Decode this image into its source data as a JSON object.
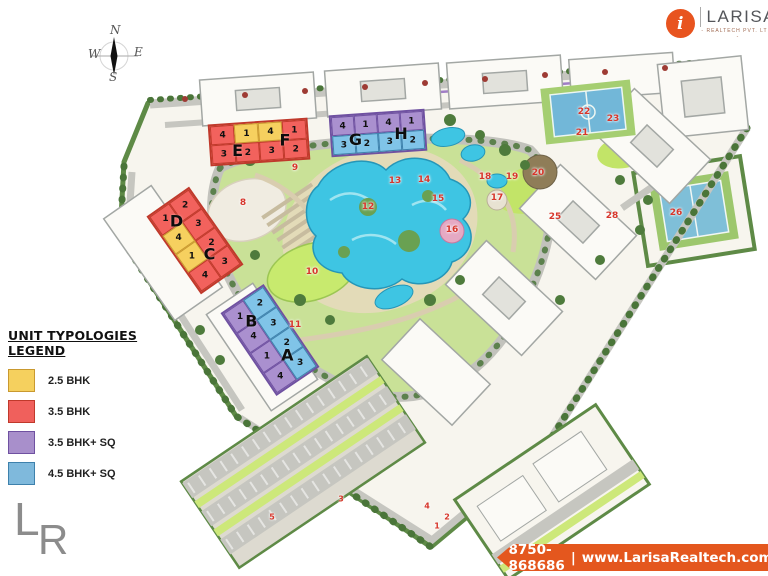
{
  "brand": {
    "name": "LARISA",
    "tagline": "- REALTECH PVT. LTD. -",
    "logo_letter": "i",
    "accent": "#E8541F"
  },
  "compass": {
    "north": "N",
    "south": "S",
    "east": "E",
    "west": "W"
  },
  "legend": {
    "title": "UNIT TYPOLOGIES LEGEND",
    "items": [
      {
        "label": "2.5 BHK",
        "color": "#F5D05E",
        "border": "#C9992F"
      },
      {
        "label": "3.5 BHK",
        "color": "#F0605C",
        "border": "#C0392B"
      },
      {
        "label": "3.5 BHK+ SQ",
        "color": "#A88FCB",
        "border": "#6F51A1"
      },
      {
        "label": "4.5 BHK+ SQ",
        "color": "#7FB9DC",
        "border": "#3E81AC"
      }
    ]
  },
  "footer": {
    "phone": "8750-868686",
    "separator": "|",
    "website": "www.LarisaRealtech.com",
    "bg": "#E4571E"
  },
  "watermark": {
    "letter_l": "L",
    "letter_r": "R"
  },
  "unit_colors": {
    "yellow": {
      "fill": "#F6D05F",
      "border": "#C9992F"
    },
    "red": {
      "fill": "#F2625D",
      "border": "#C0392B"
    },
    "purple": {
      "fill": "#AA90CF",
      "border": "#6F51A1"
    },
    "blue": {
      "fill": "#80C4E8",
      "border": "#3E81AC"
    }
  },
  "blocks": [
    {
      "name": "EF",
      "x": 209,
      "y": 121,
      "w": 100,
      "h": 42,
      "rot": -4,
      "rows": 2,
      "cols": 4,
      "border": "red",
      "cells": [
        {
          "n": "4",
          "c": "red"
        },
        {
          "n": "1",
          "c": "yellow"
        },
        {
          "n": "4",
          "c": "yellow"
        },
        {
          "n": "1",
          "c": "red"
        },
        {
          "n": "3",
          "c": "red"
        },
        {
          "n": "2",
          "c": "red"
        },
        {
          "n": "3",
          "c": "red"
        },
        {
          "n": "2",
          "c": "red"
        }
      ],
      "letters": [
        {
          "t": "E",
          "x": 27,
          "y": 68
        },
        {
          "t": "F",
          "x": 77,
          "y": 50
        }
      ]
    },
    {
      "name": "GH",
      "x": 330,
      "y": 112,
      "w": 96,
      "h": 42,
      "rot": -4,
      "rows": 2,
      "cols": 4,
      "border": "purple",
      "cells": [
        {
          "n": "4",
          "c": "purple"
        },
        {
          "n": "1",
          "c": "purple"
        },
        {
          "n": "4",
          "c": "purple"
        },
        {
          "n": "1",
          "c": "purple"
        },
        {
          "n": "3",
          "c": "blue"
        },
        {
          "n": "2",
          "c": "blue"
        },
        {
          "n": "3",
          "c": "blue"
        },
        {
          "n": "2",
          "c": "blue"
        }
      ],
      "letters": [
        {
          "t": "G",
          "x": 25,
          "y": 62
        },
        {
          "t": "H",
          "x": 75,
          "y": 55
        }
      ]
    },
    {
      "name": "DC",
      "x": 169,
      "y": 193,
      "w": 52,
      "h": 95,
      "rot": -35,
      "rows": 4,
      "cols": 2,
      "border": "red",
      "cells": [
        {
          "n": "1",
          "c": "red"
        },
        {
          "n": "2",
          "c": "red"
        },
        {
          "n": "4",
          "c": "yellow"
        },
        {
          "n": "3",
          "c": "red"
        },
        {
          "n": "1",
          "c": "yellow"
        },
        {
          "n": "2",
          "c": "red"
        },
        {
          "n": "4",
          "c": "red"
        },
        {
          "n": "3",
          "c": "red"
        }
      ],
      "letters": [
        {
          "t": "D",
          "x": 42,
          "y": 21
        },
        {
          "t": "C",
          "x": 58,
          "y": 71
        }
      ]
    },
    {
      "name": "BA",
      "x": 244,
      "y": 290,
      "w": 52,
      "h": 100,
      "rot": -34,
      "rows": 4,
      "cols": 2,
      "border": "purple",
      "cells": [
        {
          "n": "1",
          "c": "purple"
        },
        {
          "n": "2",
          "c": "blue"
        },
        {
          "n": "4",
          "c": "purple"
        },
        {
          "n": "3",
          "c": "blue"
        },
        {
          "n": "1",
          "c": "purple"
        },
        {
          "n": "2",
          "c": "blue"
        },
        {
          "n": "4",
          "c": "purple"
        },
        {
          "n": "3",
          "c": "blue"
        }
      ],
      "letters": [
        {
          "t": "B",
          "x": 40,
          "y": 23
        },
        {
          "t": "A",
          "x": 62,
          "y": 73
        }
      ]
    }
  ],
  "markers": [
    {
      "n": "8",
      "x": 243,
      "y": 203
    },
    {
      "n": "9",
      "x": 295,
      "y": 168
    },
    {
      "n": "10",
      "x": 312,
      "y": 272
    },
    {
      "n": "11",
      "x": 295,
      "y": 325
    },
    {
      "n": "12",
      "x": 368,
      "y": 207
    },
    {
      "n": "13",
      "x": 395,
      "y": 181
    },
    {
      "n": "14",
      "x": 424,
      "y": 180
    },
    {
      "n": "15",
      "x": 438,
      "y": 199
    },
    {
      "n": "16",
      "x": 452,
      "y": 230
    },
    {
      "n": "17",
      "x": 497,
      "y": 198
    },
    {
      "n": "18",
      "x": 485,
      "y": 177
    },
    {
      "n": "19",
      "x": 512,
      "y": 177
    },
    {
      "n": "20",
      "x": 538,
      "y": 173
    },
    {
      "n": "21",
      "x": 582,
      "y": 133
    },
    {
      "n": "22",
      "x": 584,
      "y": 112
    },
    {
      "n": "23",
      "x": 613,
      "y": 119
    },
    {
      "n": "25",
      "x": 555,
      "y": 217
    },
    {
      "n": "26",
      "x": 676,
      "y": 213
    },
    {
      "n": "28",
      "x": 612,
      "y": 216
    },
    {
      "n": "3",
      "x": 341,
      "y": 499,
      "small": true
    },
    {
      "n": "4",
      "x": 427,
      "y": 506,
      "small": true
    },
    {
      "n": "2",
      "x": 447,
      "y": 517,
      "small": true
    },
    {
      "n": "1",
      "x": 437,
      "y": 526,
      "small": true
    },
    {
      "n": "5",
      "x": 272,
      "y": 517,
      "small": true
    }
  ]
}
